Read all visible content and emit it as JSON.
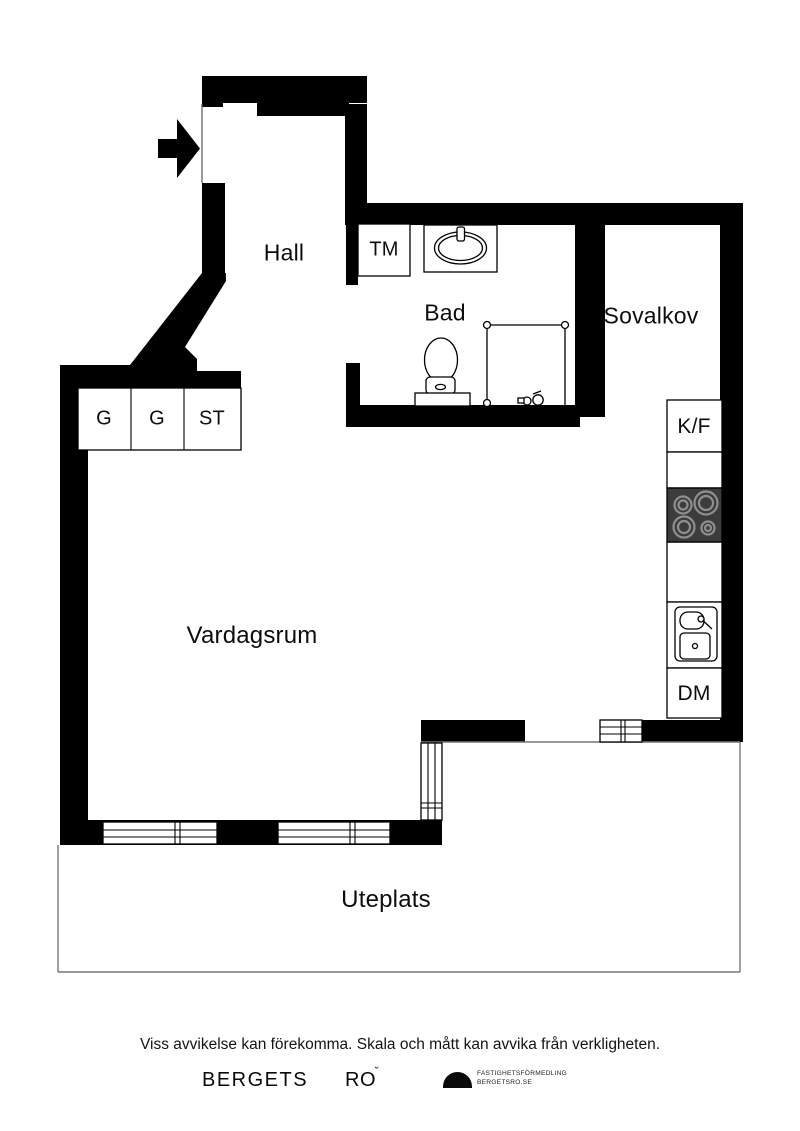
{
  "plan": {
    "rooms": [
      {
        "name": "hall",
        "label": "Hall"
      },
      {
        "name": "bad",
        "label": "Bad"
      },
      {
        "name": "sovalkov",
        "label": "Sovalkov"
      },
      {
        "name": "vardagsrum",
        "label": "Vardagsrum"
      },
      {
        "name": "uteplats",
        "label": "Uteplats"
      }
    ],
    "fixtures": {
      "washing_machine": "TM",
      "closet_1": "G",
      "closet_2": "G",
      "closet_3": "ST",
      "fridge_freezer": "K/F",
      "dishwasher": "DM"
    }
  },
  "footer": {
    "disclaimer": "Viss avvikelse kan förekomma. Skala och mått kan avvika från verkligheten.",
    "brand_word_1": "BERGETS",
    "brand_word_2": "RO",
    "brand_word_2_mark": "˘",
    "agency_line_1": "FASTIGHETSFÖRMEDLING",
    "agency_line_2": "BERGETSRO.SE"
  },
  "colors": {
    "wall": "#000000",
    "stove_body": "#3c3c3c",
    "burner_ring": "#8f8f8f",
    "burner_fill": "#666666",
    "outline_thin": "#777777"
  }
}
